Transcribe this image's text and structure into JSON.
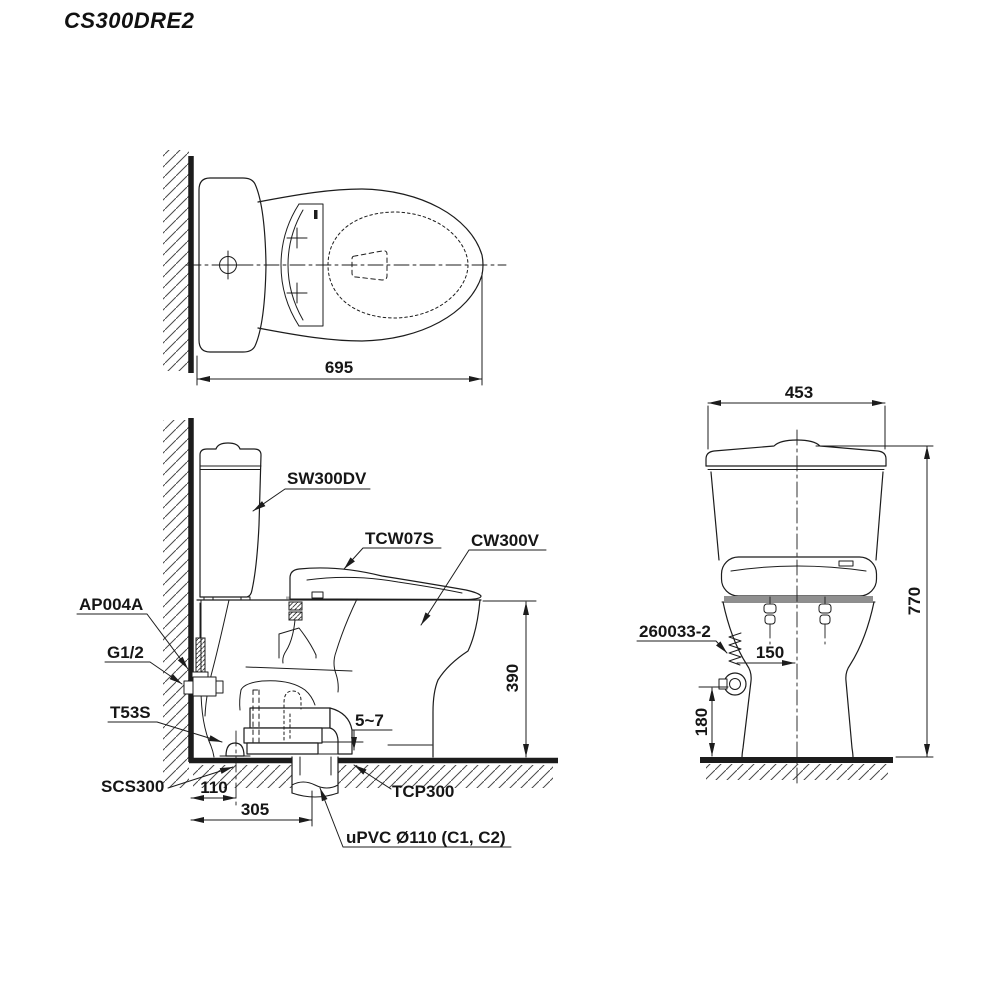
{
  "title": "CS300DRE2",
  "colors": {
    "line": "#1c1c1c",
    "background": "#ffffff"
  },
  "top_view": {
    "dim_width": "695"
  },
  "side_view": {
    "labels": {
      "cistern": "SW300DV",
      "washlet": "TCW07S",
      "bowl": "CW300V",
      "inlet_pipe": "AP004A",
      "thread": "G1/2",
      "floor_fixing": "T53S",
      "floor_flange": "SCS300",
      "outlet_socket": "TCP300",
      "drain_pipe": "uPVC Ø110 (C1, C2)"
    },
    "dims": {
      "bowl_height": "390",
      "gap": "5~7",
      "offset_fixing": "110",
      "offset_drain": "305"
    }
  },
  "front_view": {
    "labels": {
      "supply_hose": "260033-2"
    },
    "dims": {
      "width": "453",
      "height": "770",
      "valve_offset": "150",
      "valve_height": "180"
    }
  }
}
